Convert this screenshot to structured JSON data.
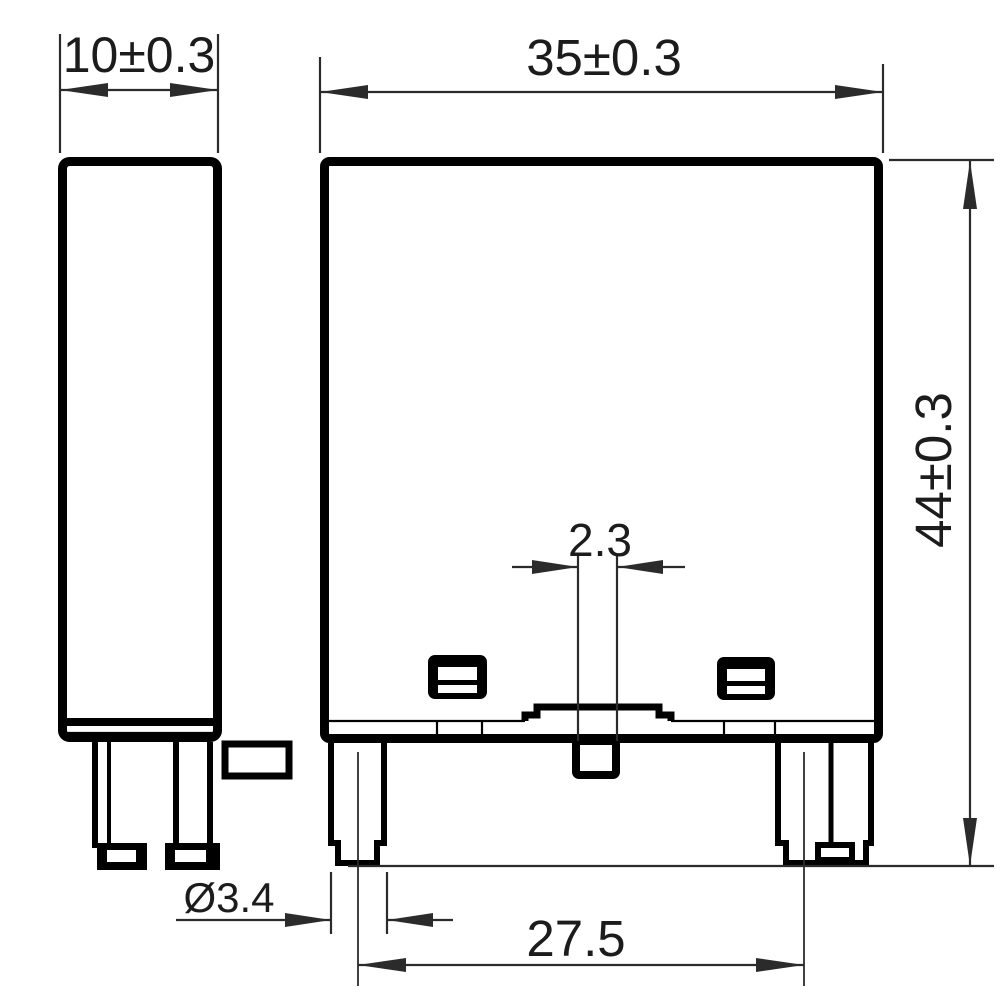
{
  "drawing": {
    "type": "engineering-dimension-drawing",
    "views": {
      "side_view": "relay side profile with two bottom pins and right-side tab",
      "front_view": "relay front profile with two outer pins, center pin, and two vent slots"
    },
    "colors": {
      "outline": "#000000",
      "dimension_lines": "#2b2b2b",
      "background": "#ffffff"
    }
  },
  "dimensions": {
    "side_width": "10±0.3",
    "body_width": "35±0.3",
    "body_height": "44±0.3",
    "center_pin_width": "2.3",
    "pin_diameter": "Ø3.4",
    "pin_pitch": "27.5"
  }
}
